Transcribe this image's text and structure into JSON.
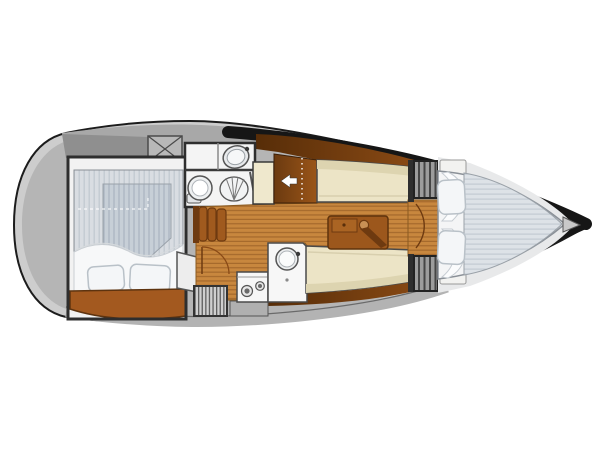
{
  "document": {
    "kind": "sailboat-interior-floorplan",
    "orientation": "bow-right"
  },
  "areas": [
    "stern-deck",
    "aft-cabin",
    "head-bathroom",
    "companionway",
    "galley",
    "salon",
    "forward-bulkhead",
    "v-berth"
  ],
  "fixtures": [
    "deck-hatch-x",
    "bathroom-sink",
    "toilet",
    "shower-basin",
    "companionway-steps",
    "entry-arrow",
    "stove-two-burners",
    "galley-round-sink",
    "salon-table-with-drawer",
    "settee-starboard",
    "settee-port",
    "hanging-locker",
    "bulkhead-lockers",
    "double-bed-aft",
    "v-berth-bed",
    "pillows",
    "door-swing-arcs"
  ],
  "colors": {
    "hull_shell": "#cdcdcd",
    "hull_outline": "#1c1c1c",
    "deck_mid": "#b5b5b5",
    "deck_light": "#a8a8a8",
    "deck_dark": "#8f8f8f",
    "bulwark": "#161616",
    "wall_dark": "#2e2e2e",
    "interior_white": "#f4f4f4",
    "fixture_white": "#f7f7f7",
    "wood_base": "#c8873e",
    "wood_stripe": "#a2662a",
    "panel_brown_dark": "#5d3108",
    "panel_brown": "#8a4a16",
    "step_brown": "#a05a1e",
    "table_brown": "#9c571c",
    "shelf_brown": "#a3591f",
    "settee_cream": "#ece4c6",
    "settee_shadow": "#ddd4b0",
    "mattress_gray": "#d9dde2",
    "mattress_stripe": "#bdc6cd",
    "pillow_white": "#f4f6f8",
    "locker_gray": "#9c9c9c",
    "arrow_white": "#ffffff"
  }
}
